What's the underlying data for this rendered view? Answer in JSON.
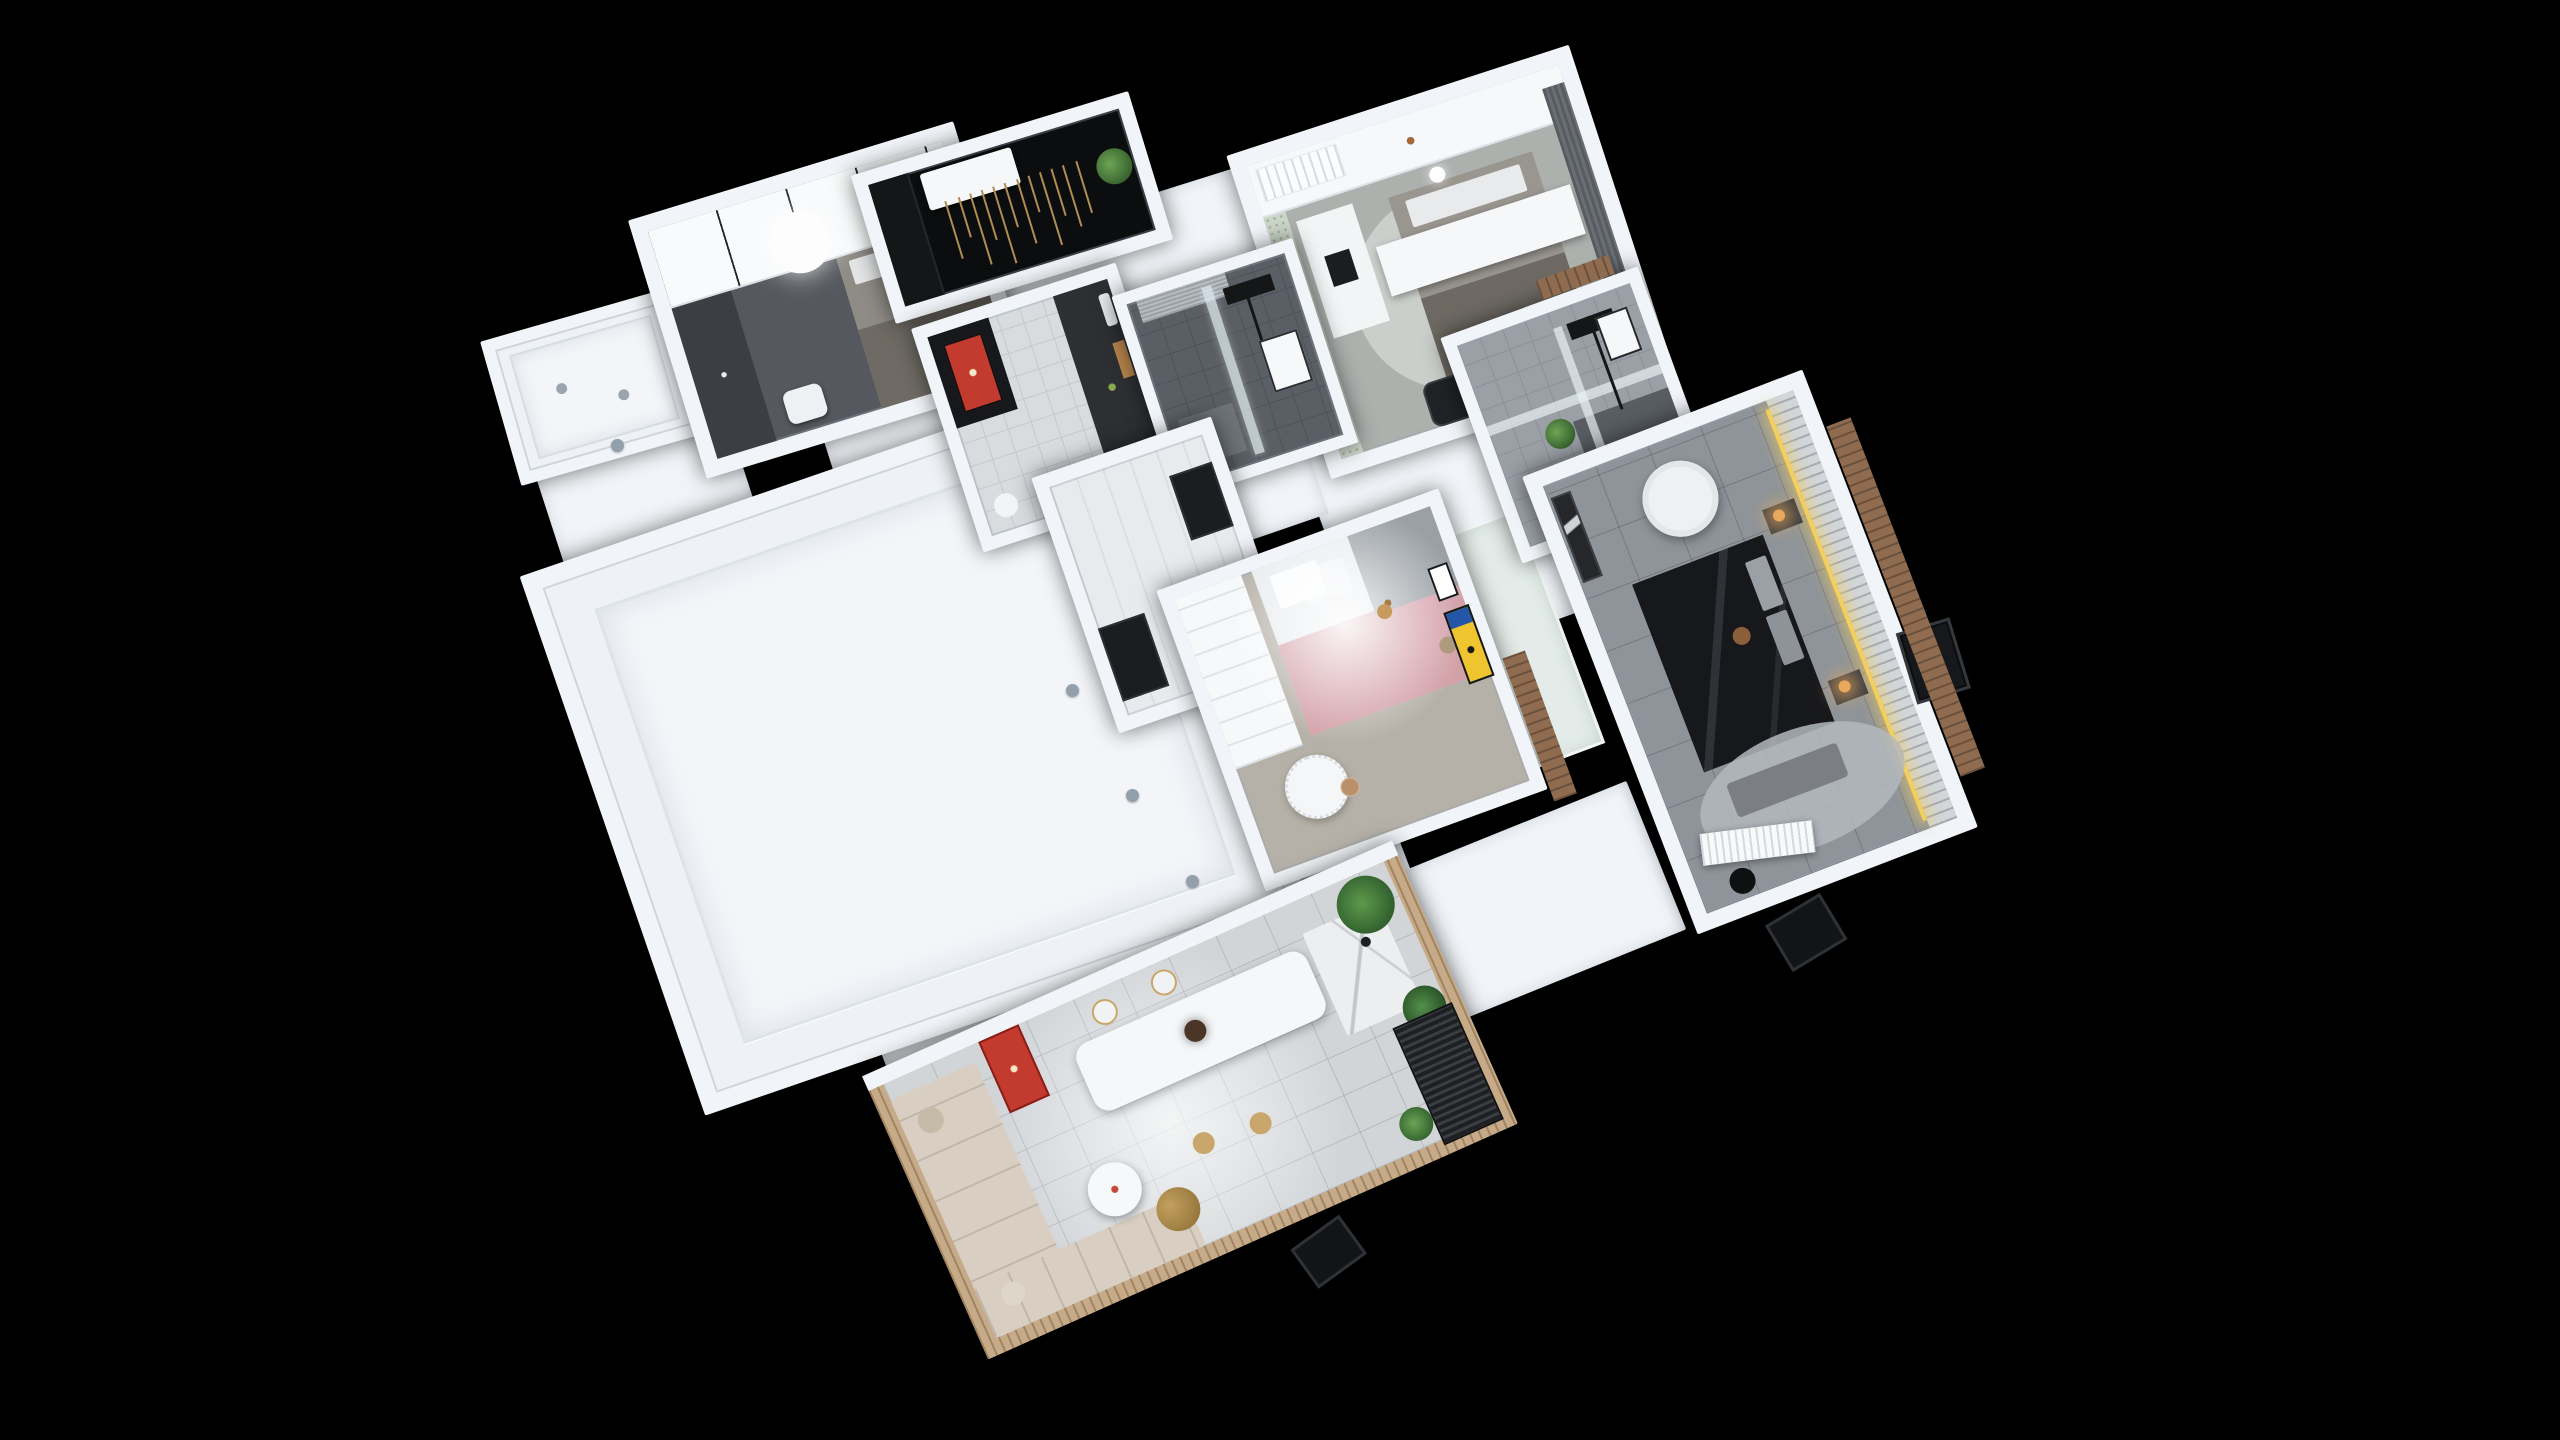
{
  "scene": {
    "label": "3D rendered apartment floor plan, top-down dollhouse view on black background",
    "background": "#000000"
  },
  "palette": {
    "bg": "#000000",
    "wall": "#f1f4f8",
    "wallShade": "#dfe5ec",
    "floorLight": "#eef1f5",
    "floorTile": "#d6dade",
    "floorDark": "#595e64",
    "entryBlack": "#0c0d0e",
    "bedDark": "#17181b",
    "sofaBeige": "#d8cfc2",
    "woodSlat": "#c7ab88",
    "brick": "#8f6c50",
    "ledYellow": "#f3cf5e",
    "lampAmber": "#e9a95c",
    "posterRed": "#c23b2e",
    "posterYellow": "#efc52f",
    "plantGreen": "#4c7d3f",
    "pinkBlanket": "#d3a0a8",
    "glassBlue": "#dfe9ef",
    "goldRod": "#b08d51",
    "dotGray": "#93a0ab"
  },
  "rooms": [
    {
      "id": "balcony-west",
      "label": "West balcony",
      "furniture": [
        "recessed floor pan",
        "two floor drains"
      ]
    },
    {
      "id": "bedroom-small",
      "label": "Small bedroom",
      "furniture": [
        "white wardrobe with vertical seams",
        "gray single bed",
        "dark desk and bookshelf",
        "white stool",
        "round white ceiling lamp"
      ]
    },
    {
      "id": "entry-hall",
      "label": "Entry hall",
      "furniture": [
        "black floor",
        "black cabinet wall",
        "white console table",
        "hanging brass rod screen",
        "green plant"
      ]
    },
    {
      "id": "bedroom-second",
      "label": "Second bedroom",
      "furniture": [
        "bed with white over-bed table",
        "north bookshelf",
        "white desk with laptop",
        "black office chair",
        "dark curtains",
        "air conditioner grille",
        "terrazzo half wall",
        "round rug"
      ]
    },
    {
      "id": "kitchen",
      "label": "Kitchen",
      "furniture": [
        "black door with red poster",
        "dark counter with food and cutting board",
        "sink",
        "white appliance",
        "white bin"
      ]
    },
    {
      "id": "bathroom-main",
      "label": "Main shower room",
      "furniture": [
        "glass shower screen",
        "black shower set",
        "white water heater",
        "roller blind",
        "dark tile floor",
        "bath mat"
      ]
    },
    {
      "id": "bathroom-ensuite",
      "label": "Ensuite bathroom",
      "furniture": [
        "frosted glass partitions",
        "black shower set",
        "green plant",
        "white wall unit",
        "dark wet zone"
      ]
    },
    {
      "id": "hallway",
      "label": "Hallway",
      "furniture": [
        "black door to kids room",
        "black door to master bedroom"
      ]
    },
    {
      "id": "empty-room",
      "label": "Unfurnished room",
      "furniture": [
        "raised white platform with border"
      ]
    },
    {
      "id": "kids-room",
      "label": "Kids bedroom",
      "furniture": [
        "bed with pink blanket and gray quilt",
        "white storage shelf",
        "scalloped round play table",
        "polka-dot rug",
        "yellow cartoon poster",
        "small framed picture",
        "plush giraffe",
        "plush bear",
        "ceiling spotlight glow"
      ]
    },
    {
      "id": "master-bedroom",
      "label": "Master bedroom",
      "furniture": [
        "black double bed",
        "round white table",
        "two nightstands with amber lamps",
        "LED strip headboard wall with slat panel",
        "gray bench",
        "white air conditioner",
        "oval rug",
        "dark wall art",
        "black pouf",
        "dried flower decor"
      ]
    },
    {
      "id": "living-dining",
      "label": "Living and dining room",
      "furniture": [
        "beige corner sofa with pillows",
        "red cartoon poster",
        "white coffee table with plates",
        "gold coffee table",
        "knit pouf",
        "long white dining table",
        "dark pendant lamp",
        "two gold-rim chairs",
        "two gold stools",
        "marble kitchen island",
        "potted plants",
        "dark balcony railing"
      ]
    }
  ],
  "exterior": {
    "features": [
      "brown brick facade strips",
      "wood slat facade around living wing",
      "dark casement window east",
      "dark casement window south",
      "dark living wing window",
      "gray wall cap dots"
    ]
  }
}
